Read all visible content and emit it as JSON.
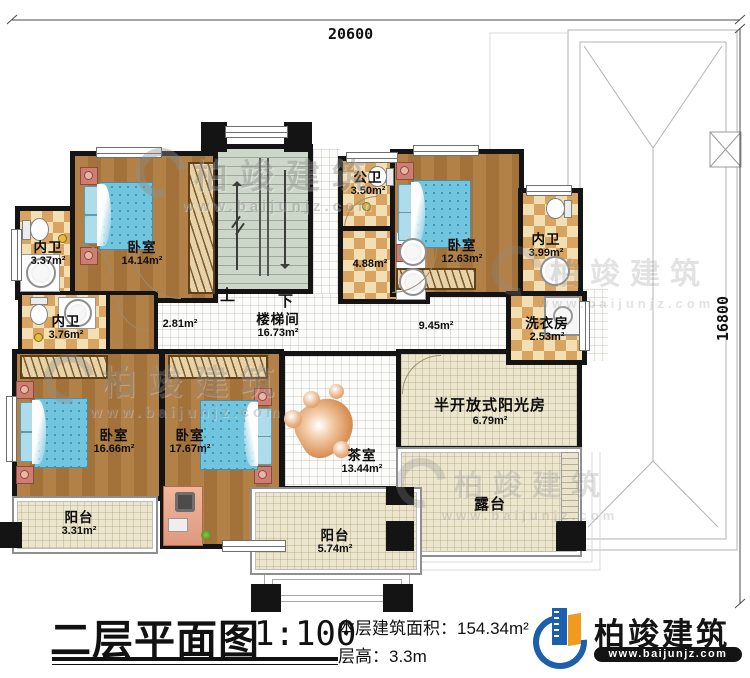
{
  "dimensions": {
    "width_label": "20600",
    "height_label": "16800"
  },
  "stairs": {
    "up": "上",
    "down": "下"
  },
  "rooms": {
    "bath_tl": {
      "name": "内卫",
      "area": "3.37m²"
    },
    "bedroom_tl": {
      "name": "卧室",
      "area": "14.14m²"
    },
    "public_bath": {
      "name": "公卫",
      "area": "3.50m²"
    },
    "basin_area": {
      "area": "4.88m²"
    },
    "bedroom_tr": {
      "name": "卧室",
      "area": "12.63m²"
    },
    "bath_tr": {
      "name": "内卫",
      "area": "3.99m²"
    },
    "stair_hall": {
      "name": "楼梯间",
      "area": "16.73m²",
      "sub_area_left": "2.81m²",
      "sub_area_right": "9.45m²"
    },
    "bath_ml": {
      "name": "内卫",
      "area": "3.76m²"
    },
    "laundry": {
      "name": "洗衣房",
      "area": "2.53m²"
    },
    "bedroom_bl": {
      "name": "卧室",
      "area": "16.66m²"
    },
    "bedroom_bc": {
      "name": "卧室",
      "area": "17.67m²"
    },
    "tea_room": {
      "name": "茶室",
      "area": "13.44m²"
    },
    "sunroom": {
      "name": "半开放式阳光房",
      "area": "6.79m²"
    },
    "terrace": {
      "name": "露台"
    },
    "balcony_left": {
      "name": "阳台",
      "area": "3.31m²"
    },
    "balcony_center": {
      "name": "阳台",
      "area": "5.74m²"
    }
  },
  "title_block": {
    "title": "二层平面图",
    "scale": "1:100",
    "area_label": "本层建筑面积：",
    "area_value": "154.34m²",
    "floor_height_label": "层高：",
    "floor_height_value": "3.3m"
  },
  "brand": {
    "name": "柏竣建筑",
    "url": "www.baijunjz.com"
  },
  "watermark": {
    "name": "柏竣建筑",
    "url": "www.baijunjz.com"
  },
  "colors": {
    "wall": "#141414",
    "wood_floor": "#a9763e",
    "bed": "#72c5de",
    "checker_dark": "#d9a360",
    "checker_light": "#f2dfb4",
    "stairs": "#ccd7c9",
    "cream_floor": "#ece6ce",
    "brand_blue": "#1b5fae",
    "brand_orange": "#f09b1f"
  }
}
